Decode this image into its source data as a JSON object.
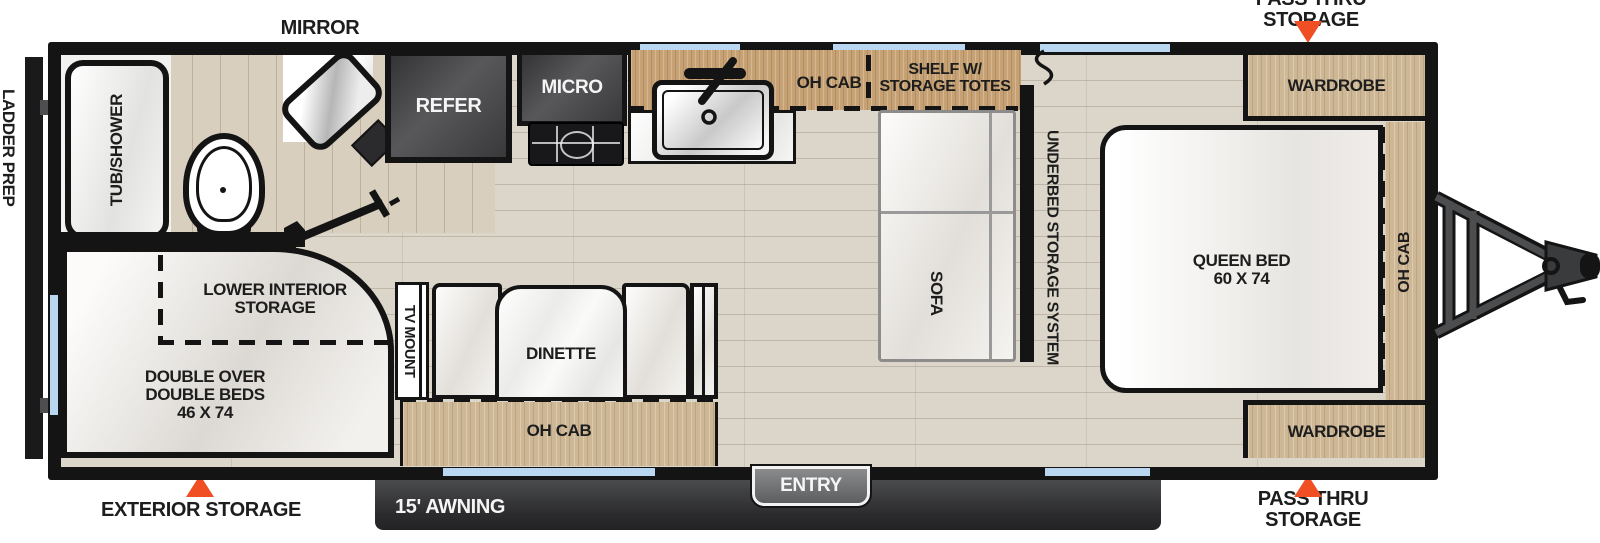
{
  "exterior": {
    "mirror_label": "MIRROR",
    "pass_thru_top": "PASS THRU STORAGE",
    "pass_thru_bottom": "PASS THRU STORAGE",
    "exterior_storage": "EXTERIOR STORAGE",
    "ladder_prep": "LADDER PREP",
    "awning": "15' AWNING",
    "entry": "ENTRY"
  },
  "bathroom": {
    "tub": "TUB/SHOWER"
  },
  "kitchen": {
    "refer": "REFER",
    "micro": "MICRO",
    "oh_cab": "OH CAB",
    "shelf_line1": "SHELF W/",
    "shelf_line2": "STORAGE TOTES"
  },
  "living": {
    "sofa": "SOFA",
    "underbed": "UNDERBED STORAGE SYSTEM",
    "tv_mount": "TV MOUNT",
    "dinette": "DINETTE",
    "oh_cab": "OH CAB"
  },
  "bedroom": {
    "queen_line1": "QUEEN BED",
    "queen_line2": "60 X 74",
    "wardrobe_top": "WARDROBE",
    "wardrobe_bottom": "WARDROBE",
    "oh_cab": "OH CAB"
  },
  "rear_bunks": {
    "storage_line1": "LOWER INTERIOR",
    "storage_line2": "STORAGE",
    "bed_line1": "DOUBLE OVER",
    "bed_line2": "DOUBLE BEDS",
    "bed_line3": "46 X 74"
  },
  "colors": {
    "accent_orange": "#F04E23",
    "window_blue": "#B9D7F0",
    "wall_black": "#141414",
    "cabinet_wood": "#CDB795",
    "counter_wood": "#C5A173",
    "awning_gray": "#3E3F41"
  }
}
